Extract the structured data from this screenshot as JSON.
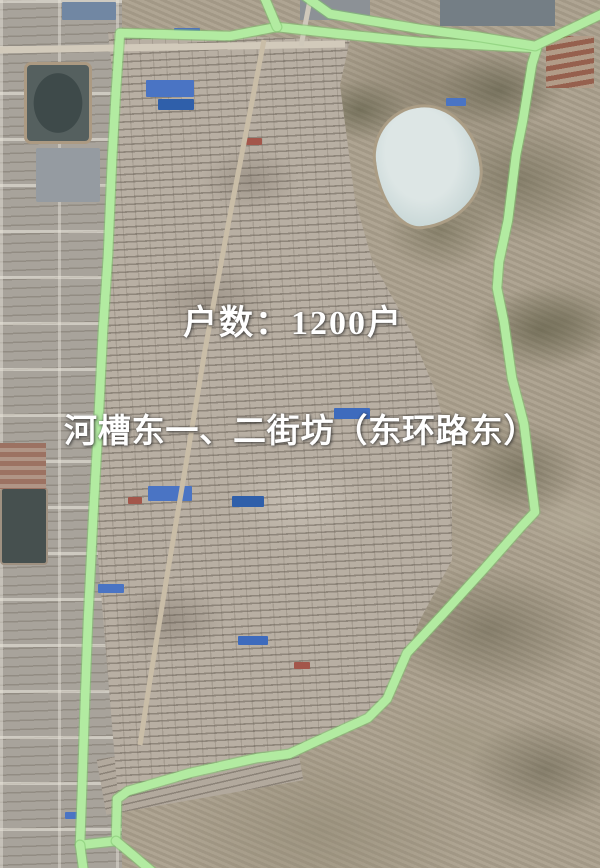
{
  "labels": {
    "households": "户数：1200户",
    "area_name": "河槽东一、二街坊（东环路东）"
  },
  "overlay": {
    "boundary_color": "#b2eba1",
    "boundary_edge_color": "#7fc56f",
    "label_text_color": "#ffffff",
    "lake_color": "#ccdbda",
    "boundary_main": [
      [
        120,
        33
      ],
      [
        230,
        36
      ],
      [
        277,
        27
      ],
      [
        340,
        34
      ],
      [
        420,
        42
      ],
      [
        478,
        45
      ],
      [
        537,
        48
      ],
      [
        532,
        64
      ],
      [
        523,
        120
      ],
      [
        516,
        155
      ],
      [
        508,
        220
      ],
      [
        499,
        262
      ],
      [
        497,
        288
      ],
      [
        504,
        322
      ],
      [
        512,
        378
      ],
      [
        524,
        424
      ],
      [
        535,
        512
      ],
      [
        521,
        527
      ],
      [
        484,
        569
      ],
      [
        444,
        613
      ],
      [
        407,
        653
      ],
      [
        387,
        699
      ],
      [
        368,
        718
      ],
      [
        317,
        741
      ],
      [
        289,
        754
      ],
      [
        257,
        758
      ],
      [
        190,
        773
      ],
      [
        128,
        791
      ],
      [
        117,
        799
      ],
      [
        116,
        841
      ],
      [
        80,
        845
      ],
      [
        82,
        790
      ],
      [
        85,
        700
      ],
      [
        88,
        620
      ],
      [
        93,
        520
      ],
      [
        98,
        430
      ],
      [
        103,
        330
      ],
      [
        108,
        255
      ],
      [
        112,
        160
      ],
      [
        116,
        90
      ]
    ],
    "boundary_spurs": [
      [
        [
          263,
          -6
        ],
        [
          277,
          27
        ]
      ],
      [
        [
          302,
          -6
        ],
        [
          330,
          14
        ],
        [
          420,
          29
        ],
        [
          480,
          37
        ],
        [
          535,
          46
        ],
        [
          604,
          13
        ]
      ],
      [
        [
          116,
          841
        ],
        [
          134,
          856
        ],
        [
          155,
          874
        ]
      ],
      [
        [
          80,
          845
        ],
        [
          84,
          874
        ]
      ]
    ]
  }
}
